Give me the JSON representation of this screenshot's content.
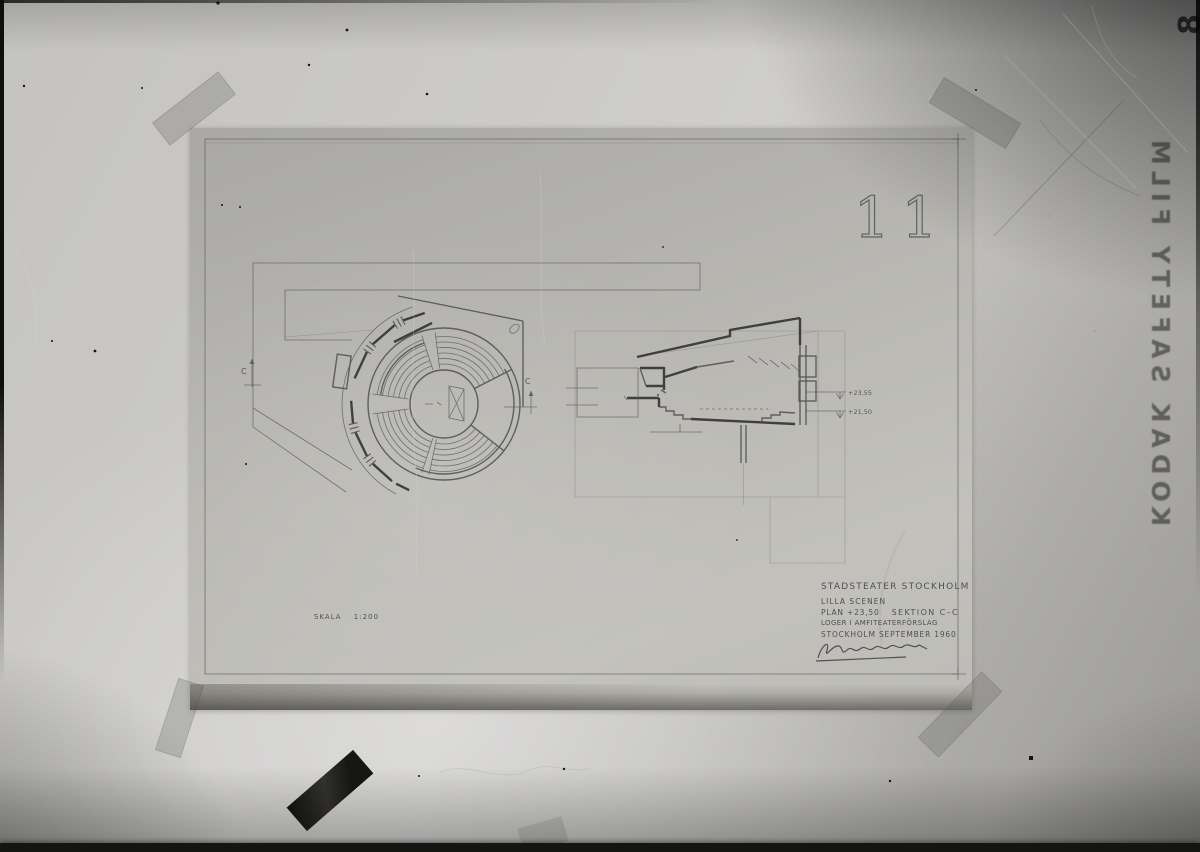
{
  "film": {
    "edge_text": "KODAK SAFETY FILM",
    "frame_mark": "8"
  },
  "drawing": {
    "sheet_number": "11",
    "scale_label": "SKALA 1:200",
    "title_block": {
      "project": "STADSTEATER STOCKHOLM",
      "subtitle": "LILLA SCENEN",
      "plan_label": "PLAN +23,50",
      "section_label": "SEKTION C–C",
      "description": "LOGER I AMFITEATERFÖRSLAG",
      "place_date": "STOCKHOLM SEPTEMBER 1960"
    },
    "plan_view": {
      "section_cut": "C"
    },
    "section_view": {
      "elevation_top": "+23,55",
      "elevation_bottom": "+21,50"
    }
  }
}
